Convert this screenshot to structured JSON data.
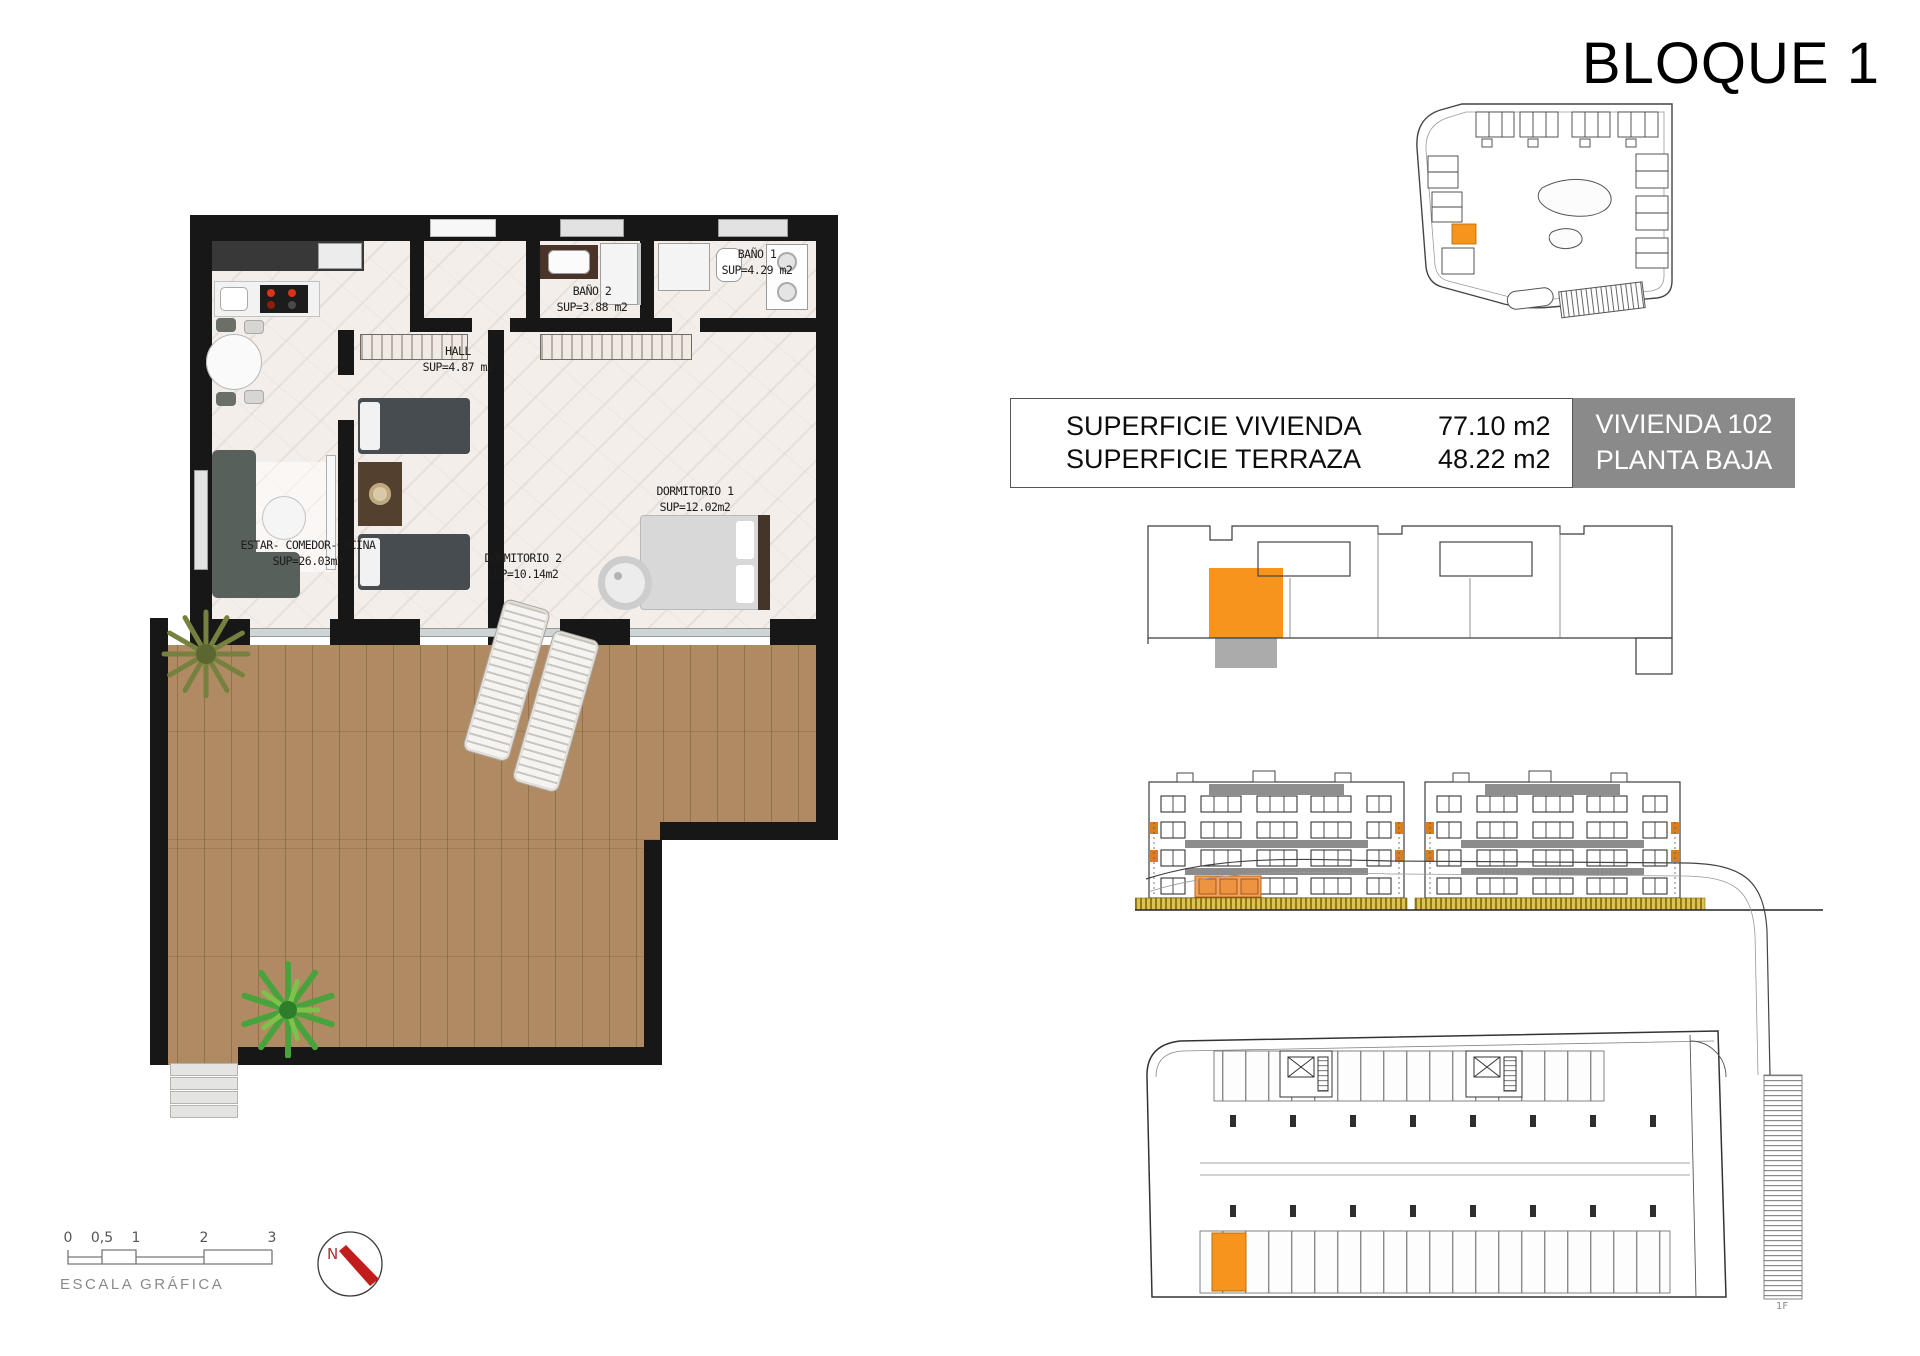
{
  "title": "BLOQUE 1",
  "info_table": {
    "rows": [
      {
        "label": "SUPERFICIE VIVIENDA",
        "value": "77.10 m2"
      },
      {
        "label": "SUPERFICIE TERRAZA",
        "value": "48.22 m2"
      }
    ],
    "unit": {
      "name": "VIVIENDA 102",
      "floor": "PLANTA BAJA"
    }
  },
  "floor_plan": {
    "rooms": {
      "bano1": {
        "name": "BAÑO 1",
        "area": "SUP=4.29 m2"
      },
      "bano2": {
        "name": "BAÑO 2",
        "area": "SUP=3.88 m2"
      },
      "hall": {
        "name": "HALL",
        "area": "SUP=4.87 m2"
      },
      "dormitorio1": {
        "name": "DORMITORIO 1",
        "area": "SUP=12.02m2"
      },
      "dormitorio2": {
        "name": "DORMITORIO 2",
        "area": "SUP=10.14m2"
      },
      "estar": {
        "name": "ESTAR- COMEDOR-COCINA",
        "area": "SUP=26.03m2"
      }
    }
  },
  "scale_bar": {
    "ticks": [
      "0",
      "0,5",
      "1",
      "2",
      "3"
    ],
    "label": "ESCALA GRÁFICA"
  },
  "compass": {
    "label": "N"
  },
  "garage_plan": {
    "footnote": "1F"
  },
  "colors": {
    "accent_orange": "#F7941D",
    "unit_box_gray": "#8A8A8A",
    "wall_black": "#171717",
    "terrace_wood": "#B08A63",
    "hedge_olive": "#B59512"
  }
}
